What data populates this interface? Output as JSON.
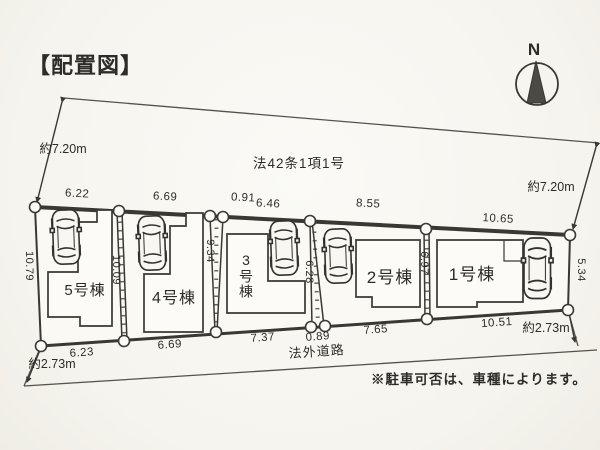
{
  "title": "【配置図】",
  "compass": {
    "north_label": "N"
  },
  "site": {
    "road_top_label": "法42条1項1号",
    "road_bottom_label": "法外道路",
    "left_depth": "約7.20m",
    "right_depth": "約7.20m",
    "bottom_left_depth": "約2.73m",
    "bottom_right_depth": "約2.73m"
  },
  "lots": [
    {
      "label": "5号棟",
      "top_width": "6.22",
      "bottom_width": "6.23"
    },
    {
      "label": "4号棟",
      "top_width": "6.69",
      "bottom_width": "6.69"
    },
    {
      "label": "3号棟",
      "top_width": "6.46",
      "bottom_width": "7.37"
    },
    {
      "label": "2号棟",
      "top_width": "8.55",
      "bottom_width": "7.65"
    },
    {
      "label": "1号棟",
      "top_width": "10.65",
      "bottom_width": "10.51"
    }
  ],
  "gaps": {
    "top": "0.91",
    "bottom": "0.89"
  },
  "side_dims": [
    "10.79",
    "10.09",
    "9.34",
    "6.28",
    "6.97",
    "5.34"
  ],
  "note": "※駐車可否は、車種によります。",
  "colors": {
    "ink": "#3a3832",
    "paper": "#f6f4ee"
  }
}
